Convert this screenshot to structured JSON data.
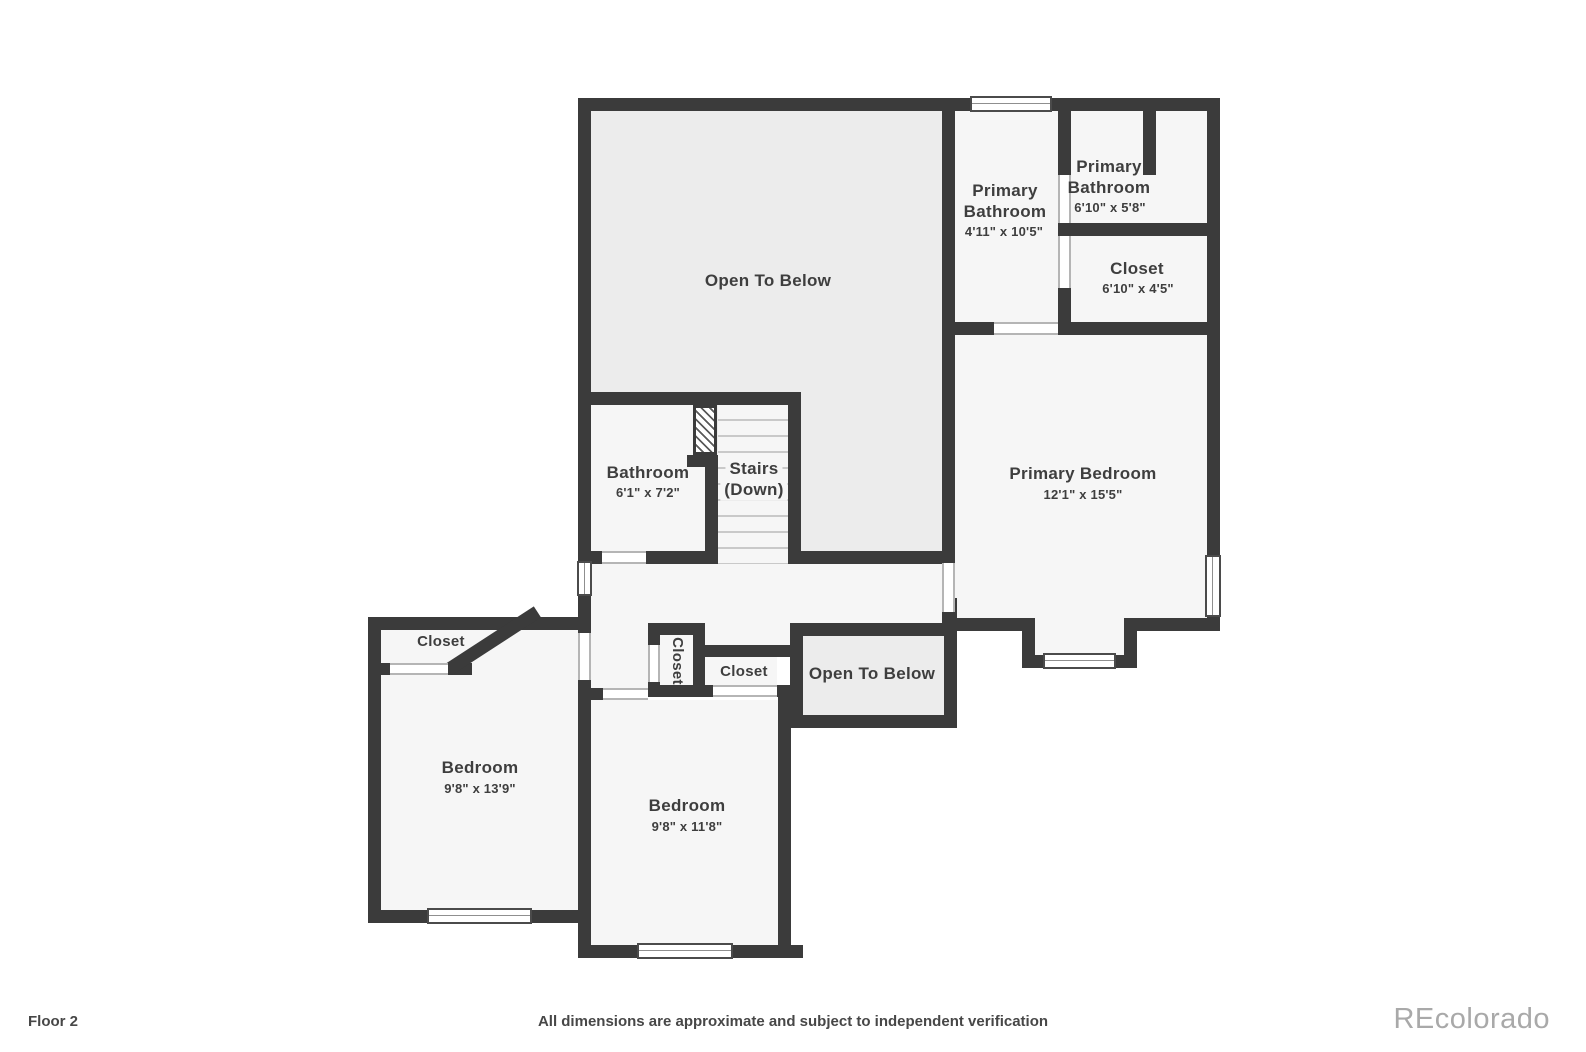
{
  "footer": {
    "floor_label": "Floor 2",
    "disclaimer": "All dimensions are approximate and subject to independent verification",
    "watermark": "REcolorado"
  },
  "colors": {
    "wall": "#3b3b3b",
    "room_fill": "#f6f6f6",
    "open_fill": "#ececec",
    "label": "#3e3e3e",
    "watermark": "#a9a9a9"
  },
  "rooms": {
    "open_main": {
      "name": "Open To Below"
    },
    "primary_bath_1": {
      "name_line1": "Primary",
      "name_line2": "Bathroom",
      "dims": "4'11\" x 10'5\""
    },
    "primary_bath_2": {
      "name_line1": "Primary",
      "name_line2": "Bathroom",
      "dims": "6'10\" x 5'8\""
    },
    "closet_primary": {
      "name": "Closet",
      "dims": "6'10\" x 4'5\""
    },
    "primary_bedroom": {
      "name": "Primary Bedroom",
      "dims": "12'1\" x 15'5\""
    },
    "bathroom": {
      "name": "Bathroom",
      "dims": "6'1\" x 7'2\""
    },
    "stairs": {
      "name": "Stairs",
      "sub": "(Down)"
    },
    "closet_left": {
      "name": "Closet"
    },
    "closet_small_vertical": {
      "name": "Closet"
    },
    "closet_hall": {
      "name": "Closet"
    },
    "open_small": {
      "name": "Open To Below"
    },
    "bedroom_left": {
      "name": "Bedroom",
      "dims": "9'8\" x 13'9\""
    },
    "bedroom_middle": {
      "name": "Bedroom",
      "dims": "9'8\" x 11'8\""
    }
  }
}
